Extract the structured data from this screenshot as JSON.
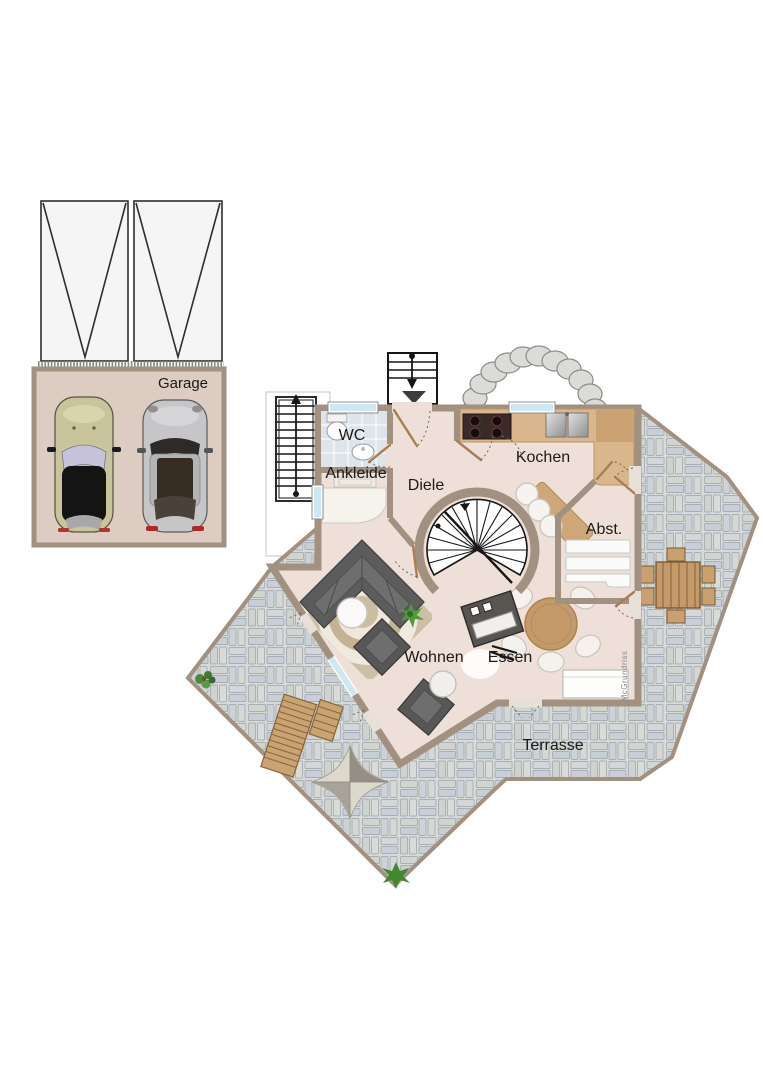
{
  "floorplan": {
    "watermark": "McGrundriss",
    "rooms": [
      {
        "id": "garage",
        "label": "Garage"
      },
      {
        "id": "wc",
        "label": "WC"
      },
      {
        "id": "ankleide",
        "label": "Ankleide"
      },
      {
        "id": "diele",
        "label": "Diele"
      },
      {
        "id": "kochen",
        "label": "Kochen"
      },
      {
        "id": "abstellraum",
        "label": "Abst."
      },
      {
        "id": "wohnen",
        "label": "Wohnen"
      },
      {
        "id": "essen",
        "label": "Essen"
      },
      {
        "id": "terrasse",
        "label": "Terrasse"
      }
    ],
    "colors": {
      "wall": "#a29180",
      "floor": "#eedfd8",
      "garage_floor": "#ddccc2",
      "terrace_stone": "#d7dad6",
      "counter": "#d9b68c",
      "wood": "#c49a6a",
      "window": "#cfe7f0",
      "sofa": "#5c5c5c",
      "rug": "#cdbfa6",
      "label_text": "#1a1a1a",
      "watermark_text": "#8a8a8a"
    }
  }
}
